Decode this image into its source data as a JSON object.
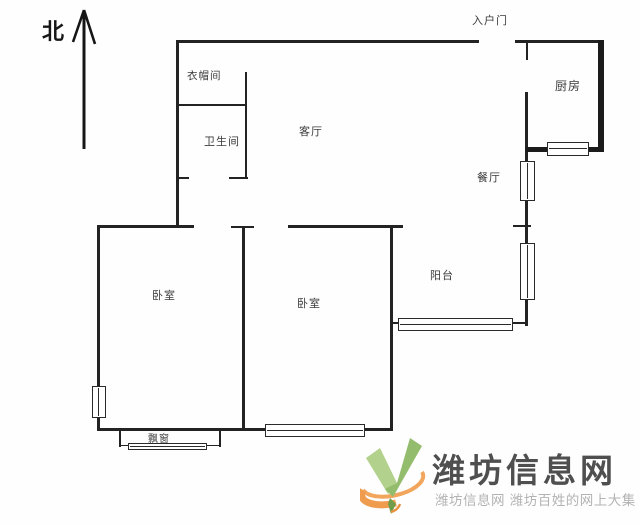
{
  "compass": {
    "north_label": "北"
  },
  "floorplan": {
    "entrance_label": "入户门",
    "rooms": {
      "cloakroom": {
        "label": "衣帽间"
      },
      "bathroom": {
        "label": "卫生间"
      },
      "living_room": {
        "label": "客厅"
      },
      "kitchen": {
        "label": "厨房"
      },
      "dining_room": {
        "label": "餐厅"
      },
      "balcony": {
        "label": "阳台"
      },
      "bedroom_left": {
        "label": "卧室"
      },
      "bedroom_middle": {
        "label": "卧室"
      },
      "bay_window": {
        "label": "飘窗"
      }
    },
    "wall_color": "#232323"
  },
  "watermark": {
    "site_name": "潍坊信息网",
    "tagline": "潍坊信息网 潍坊百姓的网上大集",
    "colors": {
      "logo_green_light": "#b2d18c",
      "logo_green_dark": "#93bd6d",
      "logo_orange": "#f2a55c",
      "site_name_color": "#4f4f4f",
      "tagline_color": "#b3b3b3"
    }
  }
}
